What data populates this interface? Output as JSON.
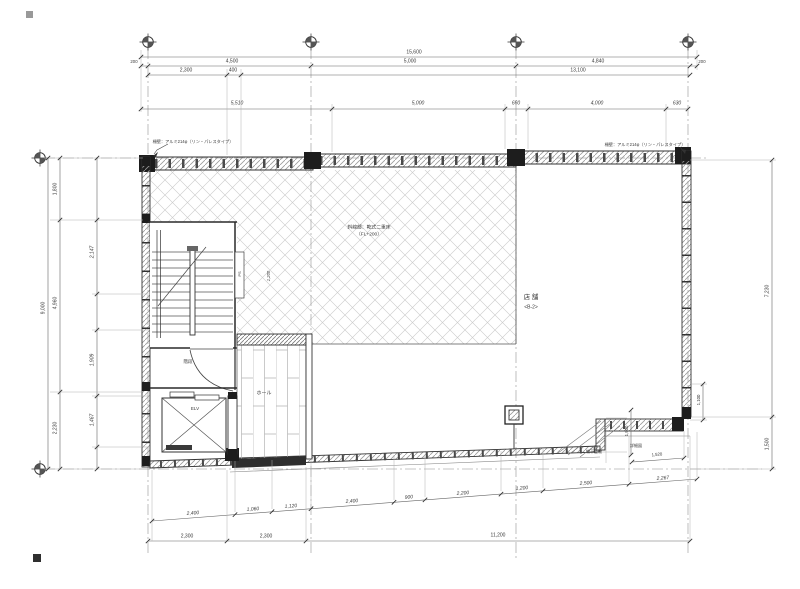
{
  "palette": {
    "line": "#333333",
    "hatch_light": "#c9c9c9",
    "wall_dark": "#1d1d1d",
    "background": "#ffffff"
  },
  "rooms": {
    "store": "店 舗",
    "store_code": "<B-2>",
    "hall": "ホール",
    "stair": "階段",
    "elevator": "ELV",
    "pipe_shaft": "PS"
  },
  "notes": {
    "railing_left": "柵壁：アルミ214φ（リン・パレスタイプ）",
    "railing_right": "柵壁：アルミ214φ（リン・パレスタイプ）",
    "hatch_line1": "斜線部：乾式二重床",
    "hatch_line2": "（FL+200）",
    "detail1": "物干金物",
    "detail2": "詳細図"
  },
  "labels": [
    {
      "n": "dim-top-overall",
      "t": "15,600",
      "x": 414,
      "y": 53
    },
    {
      "n": "dim-top",
      "t": "200",
      "x": 134,
      "y": 62,
      "s": 4.3
    },
    {
      "n": "dim-top",
      "t": "4,500",
      "x": 232,
      "y": 62
    },
    {
      "n": "dim-top",
      "t": "5,000",
      "x": 410,
      "y": 62
    },
    {
      "n": "dim-top",
      "t": "4,840",
      "x": 598,
      "y": 62
    },
    {
      "n": "dim-top",
      "t": "200",
      "x": 702,
      "y": 62,
      "s": 4.3
    },
    {
      "n": "dim-top",
      "t": "2,300",
      "x": 186,
      "y": 71
    },
    {
      "n": "dim-top",
      "t": "400",
      "x": 233,
      "y": 71
    },
    {
      "n": "dim-top",
      "t": "13,100",
      "x": 578,
      "y": 71
    },
    {
      "n": "dim-top",
      "t": "5,510",
      "x": 237,
      "y": 104,
      "i": 1
    },
    {
      "n": "dim-top",
      "t": "5,000",
      "x": 418,
      "y": 104,
      "i": 1
    },
    {
      "n": "dim-top",
      "t": "660",
      "x": 516,
      "y": 104,
      "i": 1
    },
    {
      "n": "dim-top",
      "t": "4,000",
      "x": 597,
      "y": 104,
      "i": 1
    },
    {
      "n": "dim-top",
      "t": "630",
      "x": 677,
      "y": 104,
      "i": 1
    },
    {
      "n": "dim-left-overall",
      "t": "9,000",
      "x": 44,
      "y": 308,
      "r": -90
    },
    {
      "n": "dim-left",
      "t": "1,800",
      "x": 56,
      "y": 189,
      "r": -90
    },
    {
      "n": "dim-left",
      "t": "4,960",
      "x": 56,
      "y": 303,
      "r": -90
    },
    {
      "n": "dim-left",
      "t": "2,230",
      "x": 56,
      "y": 428,
      "r": -90
    },
    {
      "n": "dim-left",
      "t": "2,147",
      "x": 93,
      "y": 252,
      "r": -90,
      "i": 1
    },
    {
      "n": "dim-left",
      "t": "1,909",
      "x": 93,
      "y": 360,
      "r": -90,
      "i": 1
    },
    {
      "n": "dim-left",
      "t": "1,467",
      "x": 93,
      "y": 420,
      "r": -90,
      "i": 1
    },
    {
      "n": "dim-right",
      "t": "7,230",
      "x": 768,
      "y": 291,
      "r": -90
    },
    {
      "n": "dim-right",
      "t": "1,500",
      "x": 768,
      "y": 444,
      "r": -90
    },
    {
      "n": "dim-step",
      "t": "1,100",
      "x": 699,
      "y": 400,
      "r": -90,
      "s": 4.3
    },
    {
      "n": "dim-step",
      "t": "1,900",
      "x": 627,
      "y": 431,
      "r": -90,
      "s": 4.3
    },
    {
      "n": "dim-step",
      "t": "1,520",
      "x": 657,
      "y": 455,
      "r": -5,
      "s": 4.3
    },
    {
      "n": "dim-chain",
      "t": "2,400",
      "x": 193,
      "y": 514,
      "r": -5,
      "i": 1
    },
    {
      "n": "dim-chain",
      "t": "1,060",
      "x": 253,
      "y": 510,
      "r": -5,
      "i": 1
    },
    {
      "n": "dim-chain",
      "t": "1,120",
      "x": 291,
      "y": 507,
      "r": -5,
      "i": 1
    },
    {
      "n": "dim-chain",
      "t": "2,400",
      "x": 352,
      "y": 502,
      "r": -5,
      "i": 1
    },
    {
      "n": "dim-chain",
      "t": "900",
      "x": 409,
      "y": 498,
      "r": -5,
      "i": 1
    },
    {
      "n": "dim-chain",
      "t": "2,200",
      "x": 463,
      "y": 494,
      "r": -5,
      "i": 1
    },
    {
      "n": "dim-chain",
      "t": "1,200",
      "x": 522,
      "y": 489,
      "r": -5,
      "i": 1
    },
    {
      "n": "dim-chain",
      "t": "2,500",
      "x": 586,
      "y": 484,
      "r": -5,
      "i": 1
    },
    {
      "n": "dim-chain",
      "t": "2,267",
      "x": 663,
      "y": 479,
      "r": -5,
      "i": 1
    },
    {
      "n": "dim-bottom",
      "t": "2,300",
      "x": 187,
      "y": 537
    },
    {
      "n": "dim-bottom",
      "t": "2,300",
      "x": 266,
      "y": 537
    },
    {
      "n": "dim-bottom",
      "t": "11,200",
      "x": 498,
      "y": 536
    },
    {
      "n": "room-label-store",
      "t": "店 舗",
      "x": 531,
      "y": 298,
      "s": 6.5
    },
    {
      "n": "room-code-store",
      "t": "<B-2>",
      "x": 531,
      "y": 308,
      "s": 5
    },
    {
      "n": "room-label-hall",
      "t": "ホール",
      "x": 264,
      "y": 394,
      "s": 5
    },
    {
      "n": "room-label-stair",
      "t": "階段",
      "x": 188,
      "y": 362,
      "s": 4.5
    },
    {
      "n": "room-label-elevator",
      "t": "ELV",
      "x": 195,
      "y": 409,
      "s": 4.5
    },
    {
      "n": "room-label-ps",
      "t": "PS",
      "x": 240,
      "y": 274,
      "r": -90,
      "s": 4
    },
    {
      "n": "dim-interior",
      "t": "1,200",
      "x": 269,
      "y": 276,
      "r": -90,
      "s": 4.2,
      "i": 1
    },
    {
      "n": "note-hatch-1",
      "t": "斜線部：乾式二重床",
      "x": 369,
      "y": 229,
      "s": 4.8
    },
    {
      "n": "note-hatch-2",
      "t": "（FL+200）",
      "x": 369,
      "y": 236,
      "s": 4.8
    },
    {
      "n": "note-railing-left",
      "t": "柵壁：アルミ214φ（リン・パレスタイプ）",
      "x": 193,
      "y": 142,
      "s": 4.2
    },
    {
      "n": "note-railing-right",
      "t": "柵壁：アルミ214φ（リン・パレスタイプ）",
      "x": 645,
      "y": 145,
      "s": 4.2
    },
    {
      "n": "note-detail-1",
      "t": "物干金物",
      "x": 594,
      "y": 452,
      "s": 4
    },
    {
      "n": "note-detail-2",
      "t": "詳細図",
      "x": 636,
      "y": 446,
      "s": 4
    }
  ]
}
